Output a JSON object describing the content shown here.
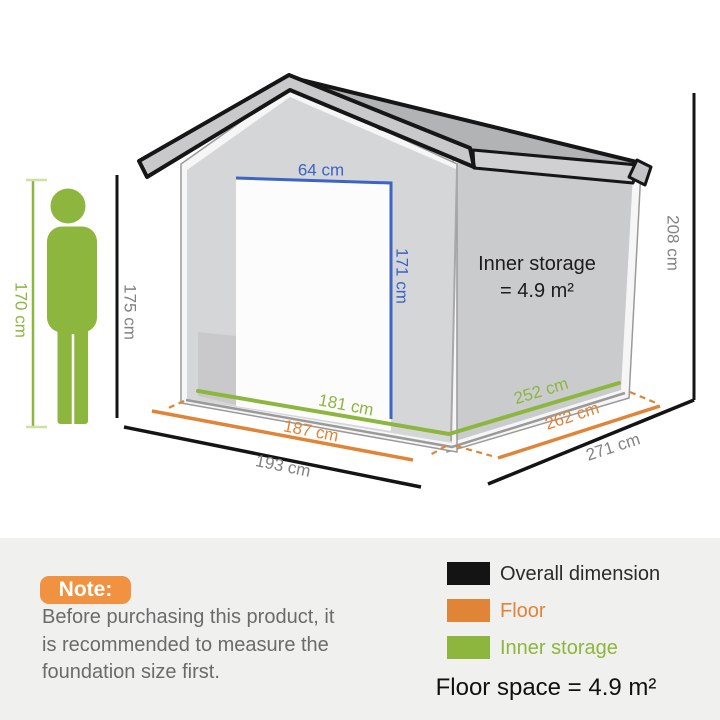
{
  "diagram": {
    "person_height": "170 cm",
    "reference_height": "175 cm",
    "door_width": "64 cm",
    "door_height": "171 cm",
    "inner_width": "181 cm",
    "floor_width": "187 cm",
    "overall_width": "193 cm",
    "inner_depth": "252 cm",
    "floor_depth": "262 cm",
    "overall_depth": "271 cm",
    "overall_height": "208 cm",
    "inner_storage_title": "Inner storage",
    "inner_storage_value": "= 4.9 m²"
  },
  "note": {
    "badge_label": "Note:",
    "lines": [
      "Before purchasing this product, it",
      "is recommended to measure the",
      "foundation size first."
    ]
  },
  "legend": {
    "items": [
      {
        "label": "Overall dimension",
        "color": "#141414"
      },
      {
        "label": "Floor",
        "color": "#e08438"
      },
      {
        "label": "Inner storage",
        "color": "#8db63e"
      }
    ],
    "floor_space": "Floor space = 4.9 m²"
  },
  "colors": {
    "overall_dimension_black": "#141414",
    "floor_orange": "#e08438",
    "inner_storage_green": "#8db63e",
    "door_measure_blue": "#3c63c6",
    "note_badge_orange": "#f0923f",
    "person_green": "#8db63e"
  }
}
